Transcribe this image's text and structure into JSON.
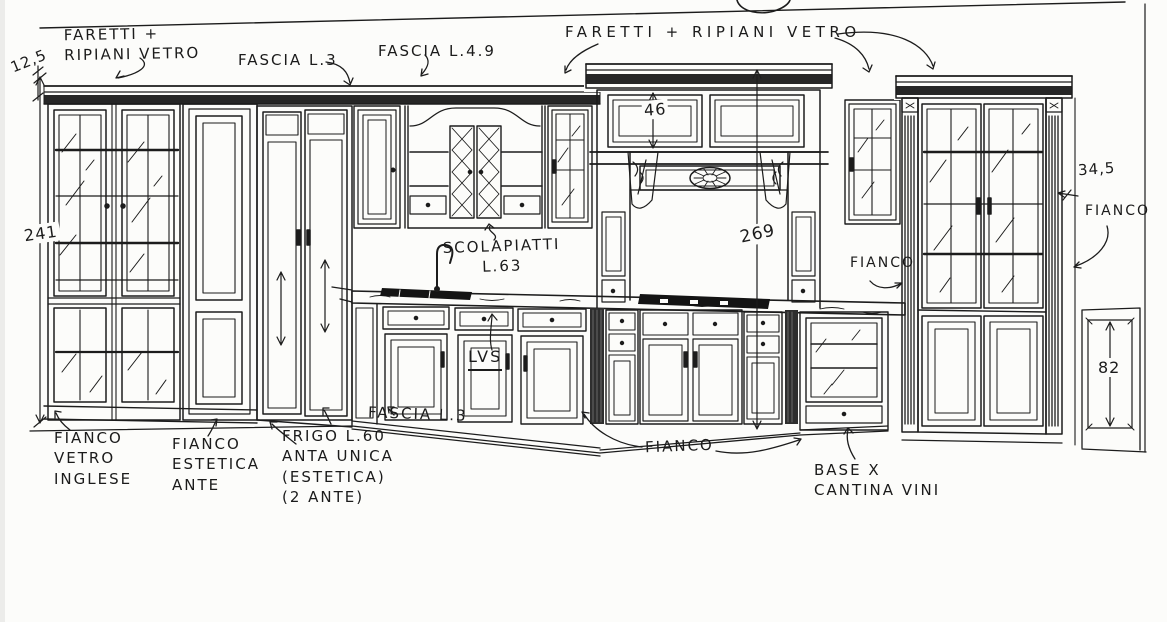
{
  "drawing": {
    "kind": "hand-drawn kitchen elevation sketch",
    "ink_color": "#1c1c1c",
    "paper_color": "#fcfcfa"
  },
  "labels": {
    "faretti_left": "FARETTI +\nRIPIANI VETRO",
    "fascia_l3_top": "FASCIA L.3",
    "fascia_l49": "FASCIA L.4.9",
    "faretti_right": "FARETTI + RIPIANI VETRO",
    "scolapiatti": "SCOLAPIATTI\nL.63",
    "lvs": "LVS",
    "fianco_mid": "FIANCO",
    "fianco_right_top": "FIANCO",
    "fianco_vetro_inglese": "FIANCO\nVETRO\nINGLESE",
    "fianco_estetica_ante": "FIANCO\nESTETICA\nANTE",
    "frigo": "FRIGO L.60\nANTA UNICA\n(ESTETICA)\n(2 ANTE)",
    "fascia_l3_bottom": "FASCIA L.3",
    "fianco_bottom": "FIANCO",
    "base_cantina": "BASE X\nCANTINA VINI"
  },
  "dimensions": {
    "d125": "12,5",
    "d241": "241",
    "d46": "46",
    "d269": "269",
    "d345": "34,5",
    "d82": "82"
  }
}
